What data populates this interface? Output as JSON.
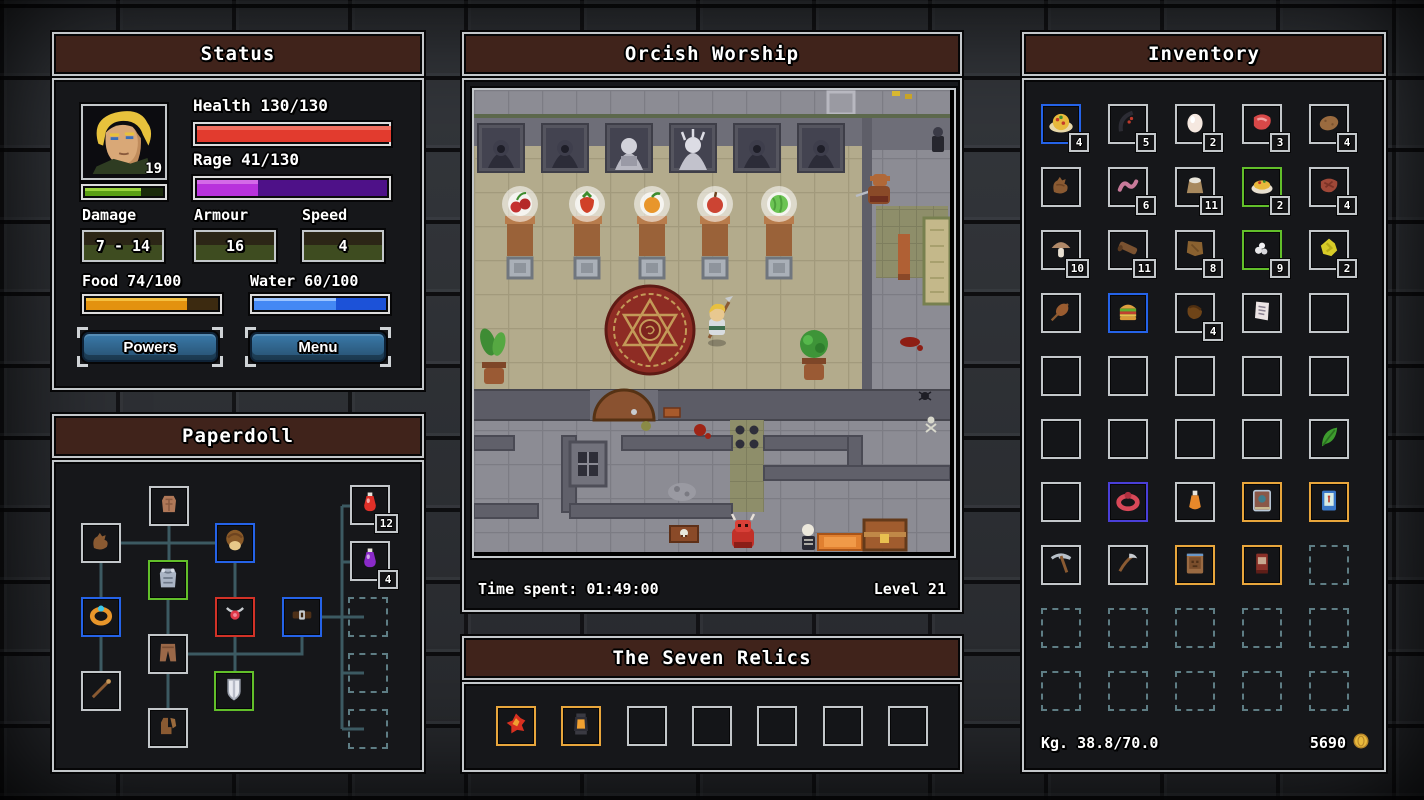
{
  "colors": {
    "panel_bg": "#16171a",
    "panel_border": "#c3c7ca",
    "title_bg": "#40231b",
    "health_fill": "#e23b2e",
    "rage_fill": "#b832dc",
    "rage_track": "#4e1188",
    "xp_fill": "#5a9e14",
    "xp_track": "#1a2a0a",
    "food_fill": "#e3920f",
    "food_track": "#3c2a10",
    "water_fill": "#4488f4",
    "water_track": "#1c52d8",
    "button_bg": "#2e5f86",
    "slot_blue": "#2563e8",
    "slot_green": "#62bf2a",
    "slot_red": "#d23227",
    "slot_orange": "#e8a63c",
    "slot_purple": "#4a3fd8",
    "dashed_slot": "#5e7d84",
    "connector": "#3c5a62",
    "gold": "#e8b93c"
  },
  "status": {
    "title": "Status",
    "level": "19",
    "health_label": "Health 130/130",
    "health_pct": 100,
    "rage_label": "Rage 41/130",
    "rage_pct": 31.5,
    "xp_pct": 68,
    "damage_label": "Damage",
    "damage_value": "7 - 14",
    "armour_label": "Armour",
    "armour_value": "16",
    "speed_label": "Speed",
    "speed_value": "4",
    "food_label": "Food 74/100",
    "food_pct": 74,
    "water_label": "Water 60/100",
    "water_pct": 60,
    "powers_button": "Powers",
    "menu_button": "Menu"
  },
  "paperdoll": {
    "title": "Paperdoll",
    "slots": [
      {
        "icon": "torso-icon",
        "x": 95,
        "y": 24
      },
      {
        "icon": "glove-icon",
        "x": 27,
        "y": 61
      },
      {
        "icon": "head-hair-icon",
        "border": "blue",
        "x": 161,
        "y": 61
      },
      {
        "icon": "chest-armor-icon",
        "border": "green",
        "x": 94,
        "y": 98
      },
      {
        "icon": "gold-ring-icon",
        "border": "blue",
        "x": 27,
        "y": 135
      },
      {
        "icon": "red-amulet-icon",
        "border": "red",
        "x": 161,
        "y": 135
      },
      {
        "icon": "belt-icon",
        "border": "blue",
        "x": 228,
        "y": 135
      },
      {
        "icon": "pants-icon",
        "x": 94,
        "y": 172
      },
      {
        "icon": "wand-icon",
        "x": 27,
        "y": 209
      },
      {
        "icon": "shield-icon",
        "border": "green",
        "x": 160,
        "y": 209
      },
      {
        "icon": "boots-icon",
        "x": 94,
        "y": 246
      },
      {
        "icon": "red-potion-icon",
        "count": "12",
        "x": 296,
        "y": 23
      },
      {
        "icon": "purple-potion-icon",
        "count": "4",
        "x": 296,
        "y": 79
      },
      {
        "style": "dashed",
        "x": 294,
        "y": 135
      },
      {
        "style": "dashed",
        "x": 294,
        "y": 191
      },
      {
        "style": "dashed",
        "x": 294,
        "y": 247
      }
    ]
  },
  "viewport": {
    "title": "Orcish Worship",
    "time_label": "Time spent: 01:49:00",
    "level_label": "Level 21"
  },
  "relics": {
    "title": "The Seven Relics",
    "slots": [
      {
        "icon": "relic-fire-icon",
        "border": "orange"
      },
      {
        "icon": "relic-lantern-icon",
        "border": "orange"
      },
      {},
      {},
      {},
      {},
      {}
    ]
  },
  "inventory": {
    "title": "Inventory",
    "columns": 5,
    "weight_label": "Kg. 38.8/70.0",
    "coins": "5690",
    "coin_icon": "coin-icon",
    "slots": [
      {
        "icon": "pasta-plate-icon",
        "count": "4",
        "border": "blue"
      },
      {
        "icon": "dark-bow-icon",
        "count": "5"
      },
      {
        "icon": "egg-icon",
        "count": "2"
      },
      {
        "icon": "raw-meat-icon",
        "count": "3"
      },
      {
        "icon": "potato-icon",
        "count": "4"
      },
      {
        "icon": "leather-glove-icon"
      },
      {
        "icon": "worm-icon",
        "count": "6"
      },
      {
        "icon": "flour-sack-icon",
        "count": "11"
      },
      {
        "icon": "omelette-icon",
        "count": "2",
        "border": "green"
      },
      {
        "icon": "cooked-meat-icon",
        "count": "4"
      },
      {
        "icon": "mushroom-icon",
        "count": "10"
      },
      {
        "icon": "wood-log-icon",
        "count": "11"
      },
      {
        "icon": "leather-hide-icon",
        "count": "8"
      },
      {
        "icon": "white-stones-icon",
        "count": "9",
        "border": "green"
      },
      {
        "icon": "sulfur-crystal-icon",
        "count": "2"
      },
      {
        "icon": "meat-skewer-icon"
      },
      {
        "icon": "hamburger-icon",
        "border": "blue"
      },
      {
        "icon": "leather-pouch-icon",
        "count": "4"
      },
      {
        "icon": "scroll-icon"
      },
      {},
      {},
      {},
      {},
      {},
      {},
      {},
      {},
      {},
      {},
      {
        "icon": "green-herb-icon"
      },
      {},
      {
        "icon": "red-ring-icon",
        "border": "purple"
      },
      {
        "icon": "orange-vial-icon"
      },
      {
        "icon": "gem-tome-icon",
        "border": "orange"
      },
      {
        "icon": "blue-book-icon",
        "border": "orange"
      },
      {
        "icon": "pickaxe-icon"
      },
      {
        "icon": "scythe-icon"
      },
      {
        "icon": "face-tome-icon",
        "border": "orange"
      },
      {
        "icon": "red-book-icon",
        "border": "orange"
      },
      {
        "style": "dashed"
      },
      {
        "style": "dashed"
      },
      {
        "style": "dashed"
      },
      {
        "style": "dashed"
      },
      {
        "style": "dashed"
      },
      {
        "style": "dashed"
      },
      {
        "style": "dashed"
      },
      {
        "style": "dashed"
      },
      {
        "style": "dashed"
      },
      {
        "style": "dashed"
      },
      {
        "style": "dashed"
      }
    ]
  }
}
